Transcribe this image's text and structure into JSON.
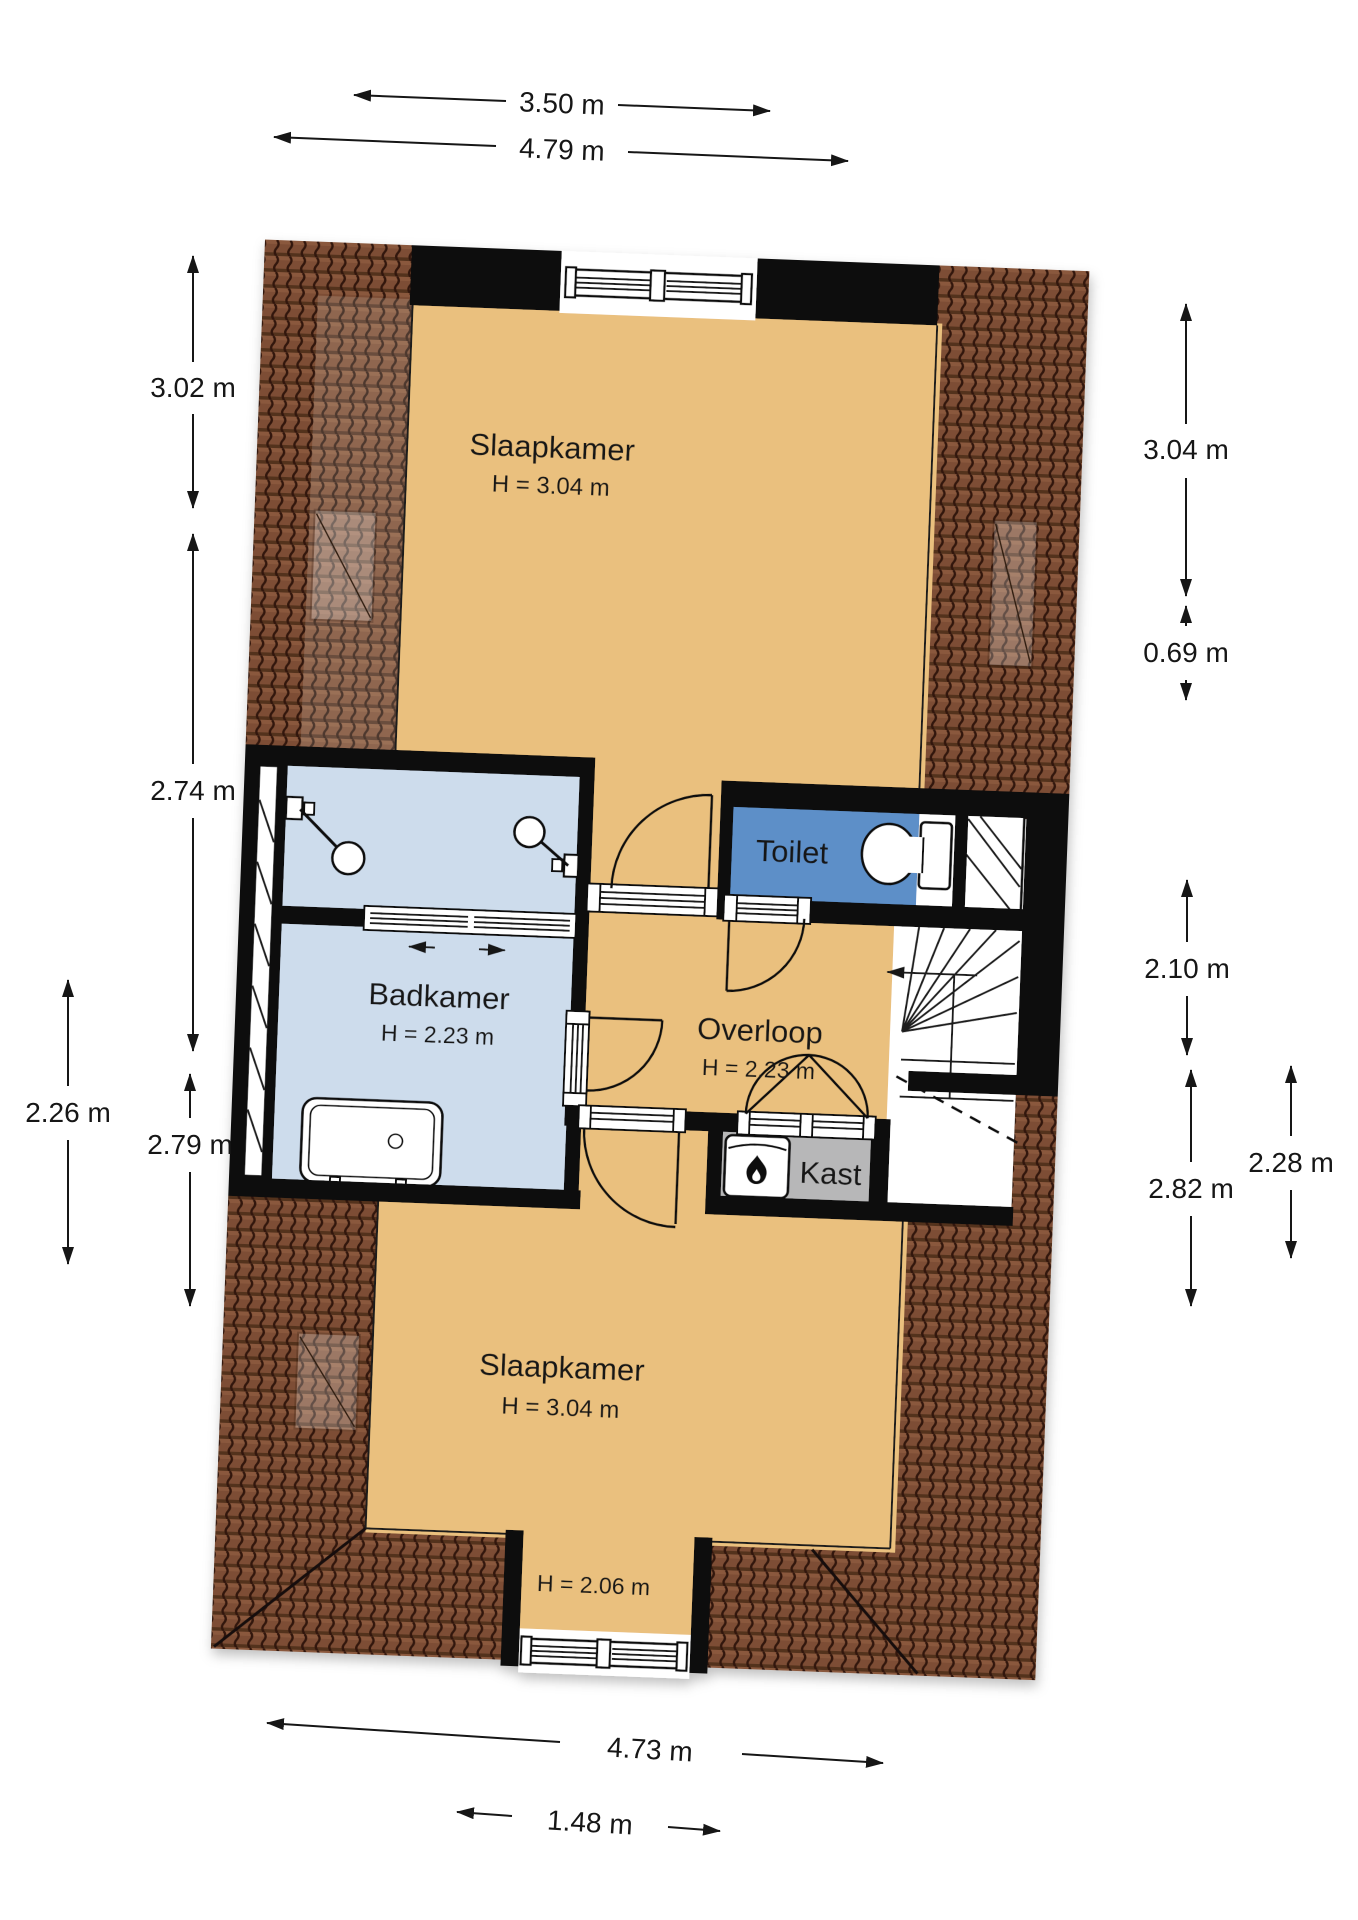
{
  "title": "Floor plan – attic storey (verdieping)",
  "labels": {
    "bedroom_top": "Slaapkamer",
    "bedroom_top_height": "H = 3.04 m",
    "bedroom_bottom": "Slaapkamer",
    "bedroom_bottom_height": "H = 3.04 m",
    "dormer_height": "H = 2.06 m",
    "bathroom": "Badkamer",
    "bathroom_height": "H = 2.23 m",
    "landing": "Overloop",
    "landing_height": "H = 2.23 m",
    "toilet": "Toilet",
    "closet": "Kast"
  },
  "dimensions": {
    "top_inner": "3.50 m",
    "top_outer": "4.79 m",
    "left_upper": "3.02 m",
    "left_middle": "2.74 m",
    "left_lower_outer": "2.26 m",
    "left_lower": "2.79 m",
    "right_upper": "3.04 m",
    "right_toilet": "0.69 m",
    "right_stairs": "2.10 m",
    "right_lower": "2.82 m",
    "right_lower_inner": "2.28 m",
    "bottom_outer": "4.73 m",
    "bottom_inner": "1.48 m"
  },
  "icons": {
    "flame": "flame-icon",
    "stair_direction": "stair-direction-arrow",
    "slide_left": "slide-left-arrow",
    "slide_right": "slide-right-arrow"
  },
  "colors": {
    "floor": "#eac07e",
    "bathroom_floor": "#cddcec",
    "toilet_floor": "#5d8fc8",
    "closet_floor": "#b7b7b8",
    "roof_tile": "#7d4d34",
    "roof_tile_dark": "#32190c",
    "wall": "#0d0d0d",
    "line": "#161616"
  }
}
